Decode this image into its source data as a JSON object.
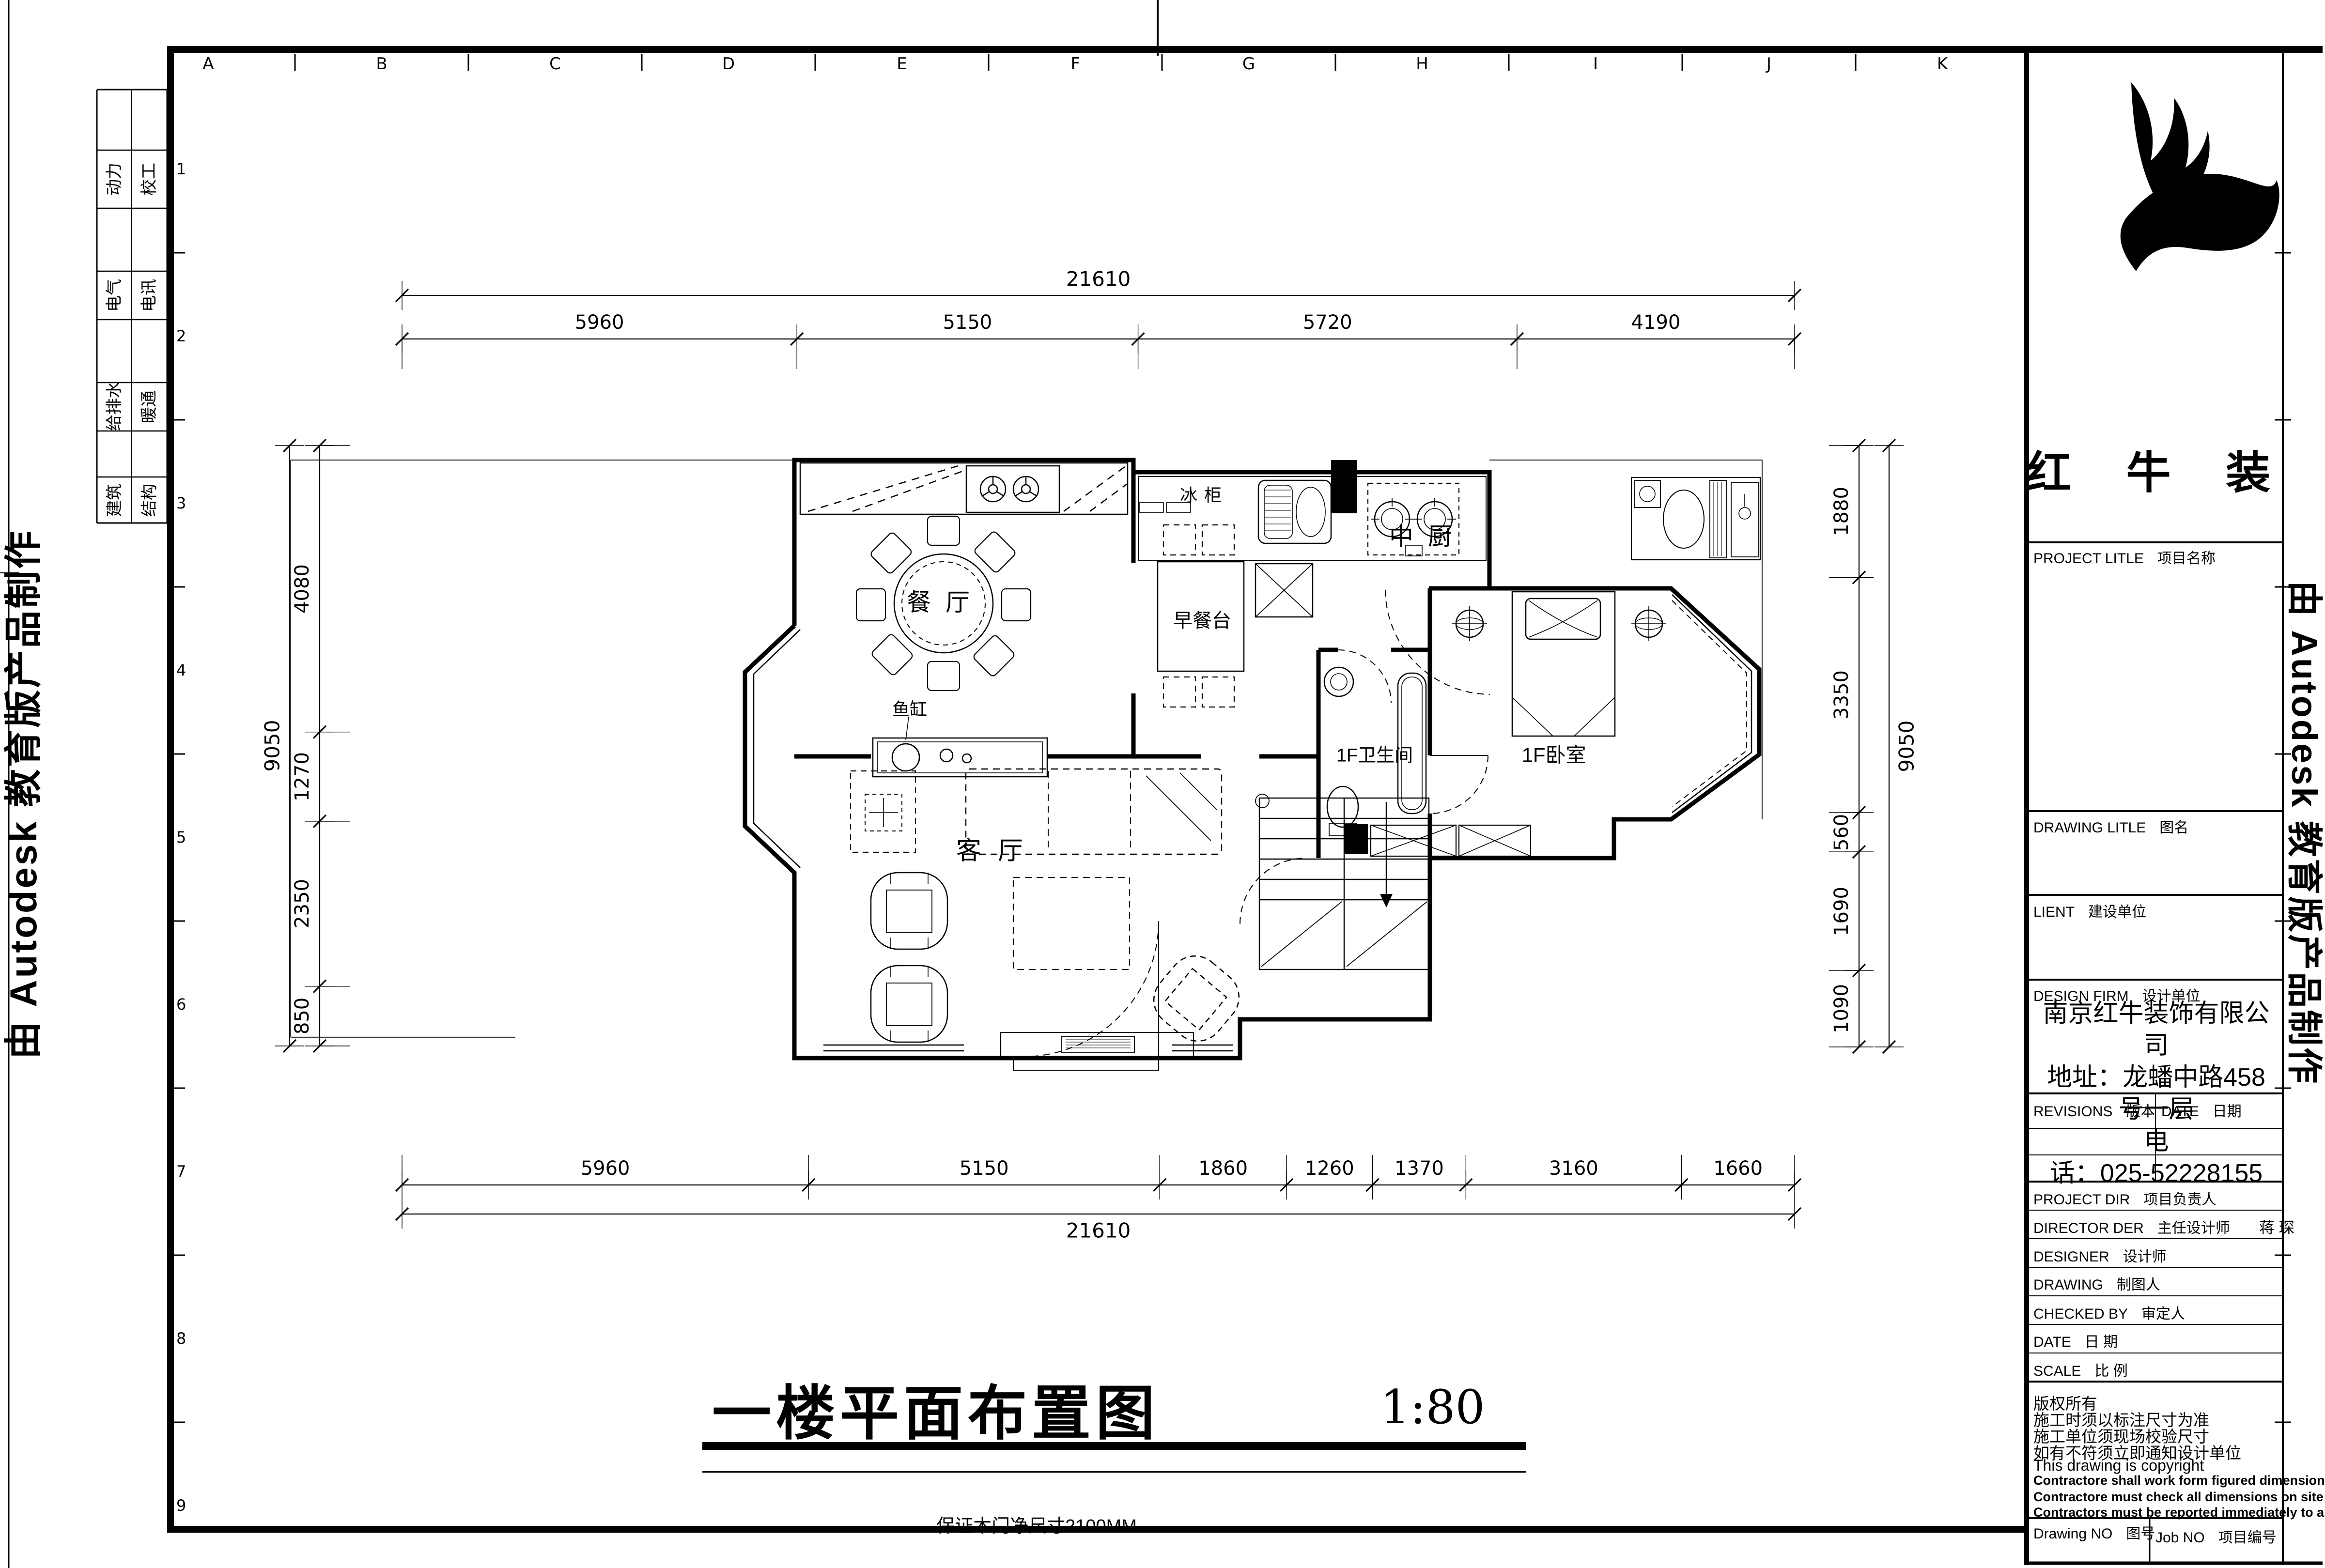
{
  "grid": {
    "columns": [
      "A",
      "B",
      "C",
      "D",
      "E",
      "F",
      "G",
      "H",
      "I",
      "J",
      "K"
    ],
    "rows": [
      "1",
      "2",
      "3",
      "4",
      "5",
      "6",
      "7",
      "8",
      "9"
    ]
  },
  "sidebar": {
    "rows": [
      [
        "动力",
        "校工"
      ],
      [
        "电气",
        "电讯"
      ],
      [
        "给排水",
        "暖通"
      ],
      [
        "建筑",
        "结构"
      ]
    ]
  },
  "watermark": "由 Autodesk 教育版产品制作",
  "plan_labels": {
    "dining": "餐厅",
    "kitchen": "中厨",
    "breakfast": "早餐台",
    "freezer": "冰柜",
    "fish_tank": "鱼缸",
    "living": "客厅",
    "bathroom": "1F卫生间",
    "bedroom": "1F卧室"
  },
  "dimensions": {
    "top": {
      "overall": "21610",
      "segments": [
        "5960",
        "5150",
        "5720",
        "4190"
      ]
    },
    "bottom": {
      "overall": "21610",
      "segments": [
        "5960",
        "5150",
        "1860",
        "1260",
        "1370",
        "3160",
        "1660"
      ]
    },
    "left": {
      "overall": "9050",
      "segments": [
        "4080",
        "1270",
        "2350",
        "850"
      ]
    },
    "right": {
      "overall": "9050",
      "segments": [
        "1880",
        "3350",
        "560",
        "1690",
        "1090"
      ]
    }
  },
  "drawing_title": {
    "text": "一楼平面布置图",
    "scale": "1:80",
    "note": "保证木门净尺寸2100MM"
  },
  "title_block": {
    "company_name": "红 牛 装 饰",
    "labels": {
      "project_title": {
        "en": "PROJECT LITLE",
        "zh": "项目名称"
      },
      "drawing_title": {
        "en": "DRAWING LITLE",
        "zh": "图名"
      },
      "client": {
        "en": "LIENT",
        "zh": "建设单位"
      },
      "design_firm": {
        "en": "DESIGN FIRM",
        "zh": "设计单位"
      },
      "revisions": {
        "en": "REVISIONS",
        "zh": "版本"
      },
      "revision_date": {
        "en": "DATE",
        "zh": "日期"
      },
      "project_dir": {
        "en": "PROJECT DIR",
        "zh": "项目负责人",
        "value": ""
      },
      "director": {
        "en": "DIRECTOR DER",
        "zh": "主任设计师",
        "value": "蒋 琛"
      },
      "designer": {
        "en": "DESIGNER",
        "zh": "设计师",
        "value": ""
      },
      "drafter": {
        "en": "DRAWING",
        "zh": "制图人",
        "value": ""
      },
      "checked": {
        "en": "CHECKED BY",
        "zh": "审定人",
        "value": ""
      },
      "date": {
        "en": "DATE",
        "zh": "日 期",
        "value": ""
      },
      "scale": {
        "en": "SCALE",
        "zh": "比 例",
        "value": ""
      },
      "drawing_no": {
        "en": "Drawing NO",
        "zh": "图号"
      },
      "job_no": {
        "en": "Job NO",
        "zh": "项目编号"
      }
    },
    "company_info": [
      "南京红牛装饰有限公",
      "司",
      "地址：龙蟠中路458",
      "号一层",
      "电",
      "话：025-52228155"
    ],
    "copyright": [
      "版权所有",
      "施工时须以标注尺寸为准",
      "施工单位须现场校验尺寸",
      "如有不符须立即通知设计单位",
      "This drawing is copyright",
      "Contractore shall work form figured dimensions only",
      "Contractore must check all dimensions on site",
      "Contractors must be reported immediately to architects"
    ]
  }
}
